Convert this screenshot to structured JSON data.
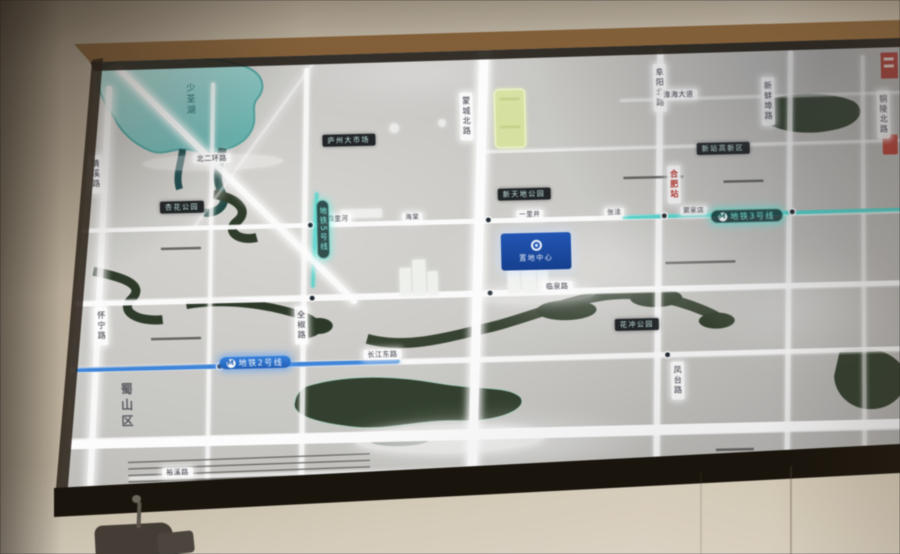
{
  "district_label": "蜀山区",
  "lake_label": "少荃湖",
  "project_plaque": {
    "name": "置地中心"
  },
  "metro": {
    "line2": "地铁2号线",
    "line3": "地铁3号线",
    "line5": "地铁5号线",
    "icon": "M"
  },
  "labels": {
    "vertical_roads": [
      {
        "text": "蒙城北路",
        "x": 398,
        "y": 62
      },
      {
        "text": "阜阳北路",
        "x": 592,
        "y": 38
      },
      {
        "text": "新蚌埠路",
        "x": 700,
        "y": 54
      },
      {
        "text": "铜陵北路",
        "x": 815,
        "y": 70
      },
      {
        "text": "全椒路",
        "x": 228,
        "y": 272
      },
      {
        "text": "怀宁路",
        "x": 28,
        "y": 268
      },
      {
        "text": "凤台路",
        "x": 603,
        "y": 336
      },
      {
        "text": "清溪路",
        "x": 26,
        "y": 116
      }
    ],
    "vertical_roads_red": [
      {
        "text": "合肥站",
        "x": 604,
        "y": 140
      }
    ],
    "horizontal_roads": [
      {
        "text": "北二环路",
        "x": 130,
        "y": 117
      },
      {
        "text": "临泉路",
        "x": 476,
        "y": 253
      },
      {
        "text": "长江东路",
        "x": 296,
        "y": 317
      },
      {
        "text": "裕溪路",
        "x": 92,
        "y": 430
      },
      {
        "text": "淮海大道",
        "x": 598,
        "y": 64
      }
    ],
    "stations": [
      {
        "text": "四里河",
        "x": 260,
        "y": 181
      },
      {
        "text": "海棠",
        "x": 338,
        "y": 181
      },
      {
        "text": "一里井",
        "x": 452,
        "y": 181
      },
      {
        "text": "张洼",
        "x": 540,
        "y": 181
      },
      {
        "text": "窦家店",
        "x": 616,
        "y": 181
      }
    ],
    "dark_pois": [
      {
        "text": "庐州大市场",
        "x": 260,
        "y": 101
      },
      {
        "text": "新天地公园",
        "x": 434,
        "y": 159
      },
      {
        "text": "花冲公园",
        "x": 548,
        "y": 292
      },
      {
        "text": "杏花公园",
        "x": 96,
        "y": 164
      },
      {
        "text": "新站高新区",
        "x": 634,
        "y": 118
      }
    ]
  },
  "colors": {
    "metro_blue": "#2f7fe0",
    "metro_teal": "#41d8cf",
    "water_teal": "#8fd4d2",
    "river_green": "#2d3b28",
    "plaque_blue": "#1c55bb",
    "landmark_yellow": "#d9e59c",
    "frame_brown": "#5e3f20"
  }
}
